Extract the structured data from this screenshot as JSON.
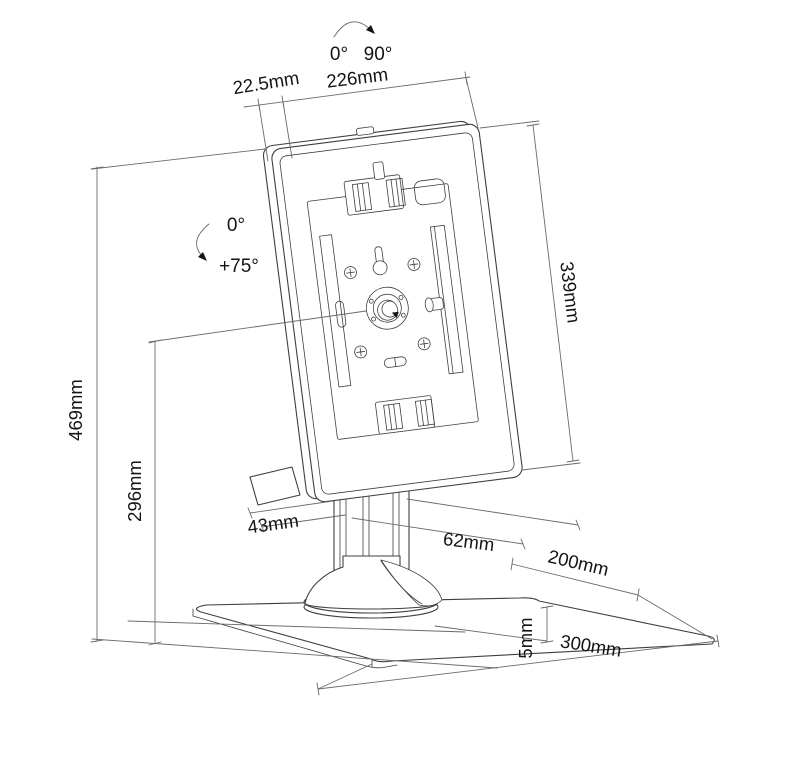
{
  "diagram": {
    "kind": "technical-dimension-drawing",
    "subject": "tablet-desk-stand-rear-view",
    "background": "#ffffff",
    "line_color": "#3f3f3f",
    "dimension_line_color": "#6a6a6a",
    "text_color": "#141414",
    "rotation_range": {
      "start": "0°",
      "end": "90°"
    },
    "tilt_range": {
      "start": "0°",
      "end": "+75°"
    },
    "dimensions": {
      "housing_thickness": "22.5mm",
      "housing_width": "226mm",
      "housing_height": "339mm",
      "total_height": "469mm",
      "pivot_height": "296mm",
      "column_width": "43mm",
      "column_depth": "62mm",
      "base_plate_depth": "200mm",
      "base_plate_width": "300mm",
      "base_plate_thickness": "5mm"
    }
  }
}
